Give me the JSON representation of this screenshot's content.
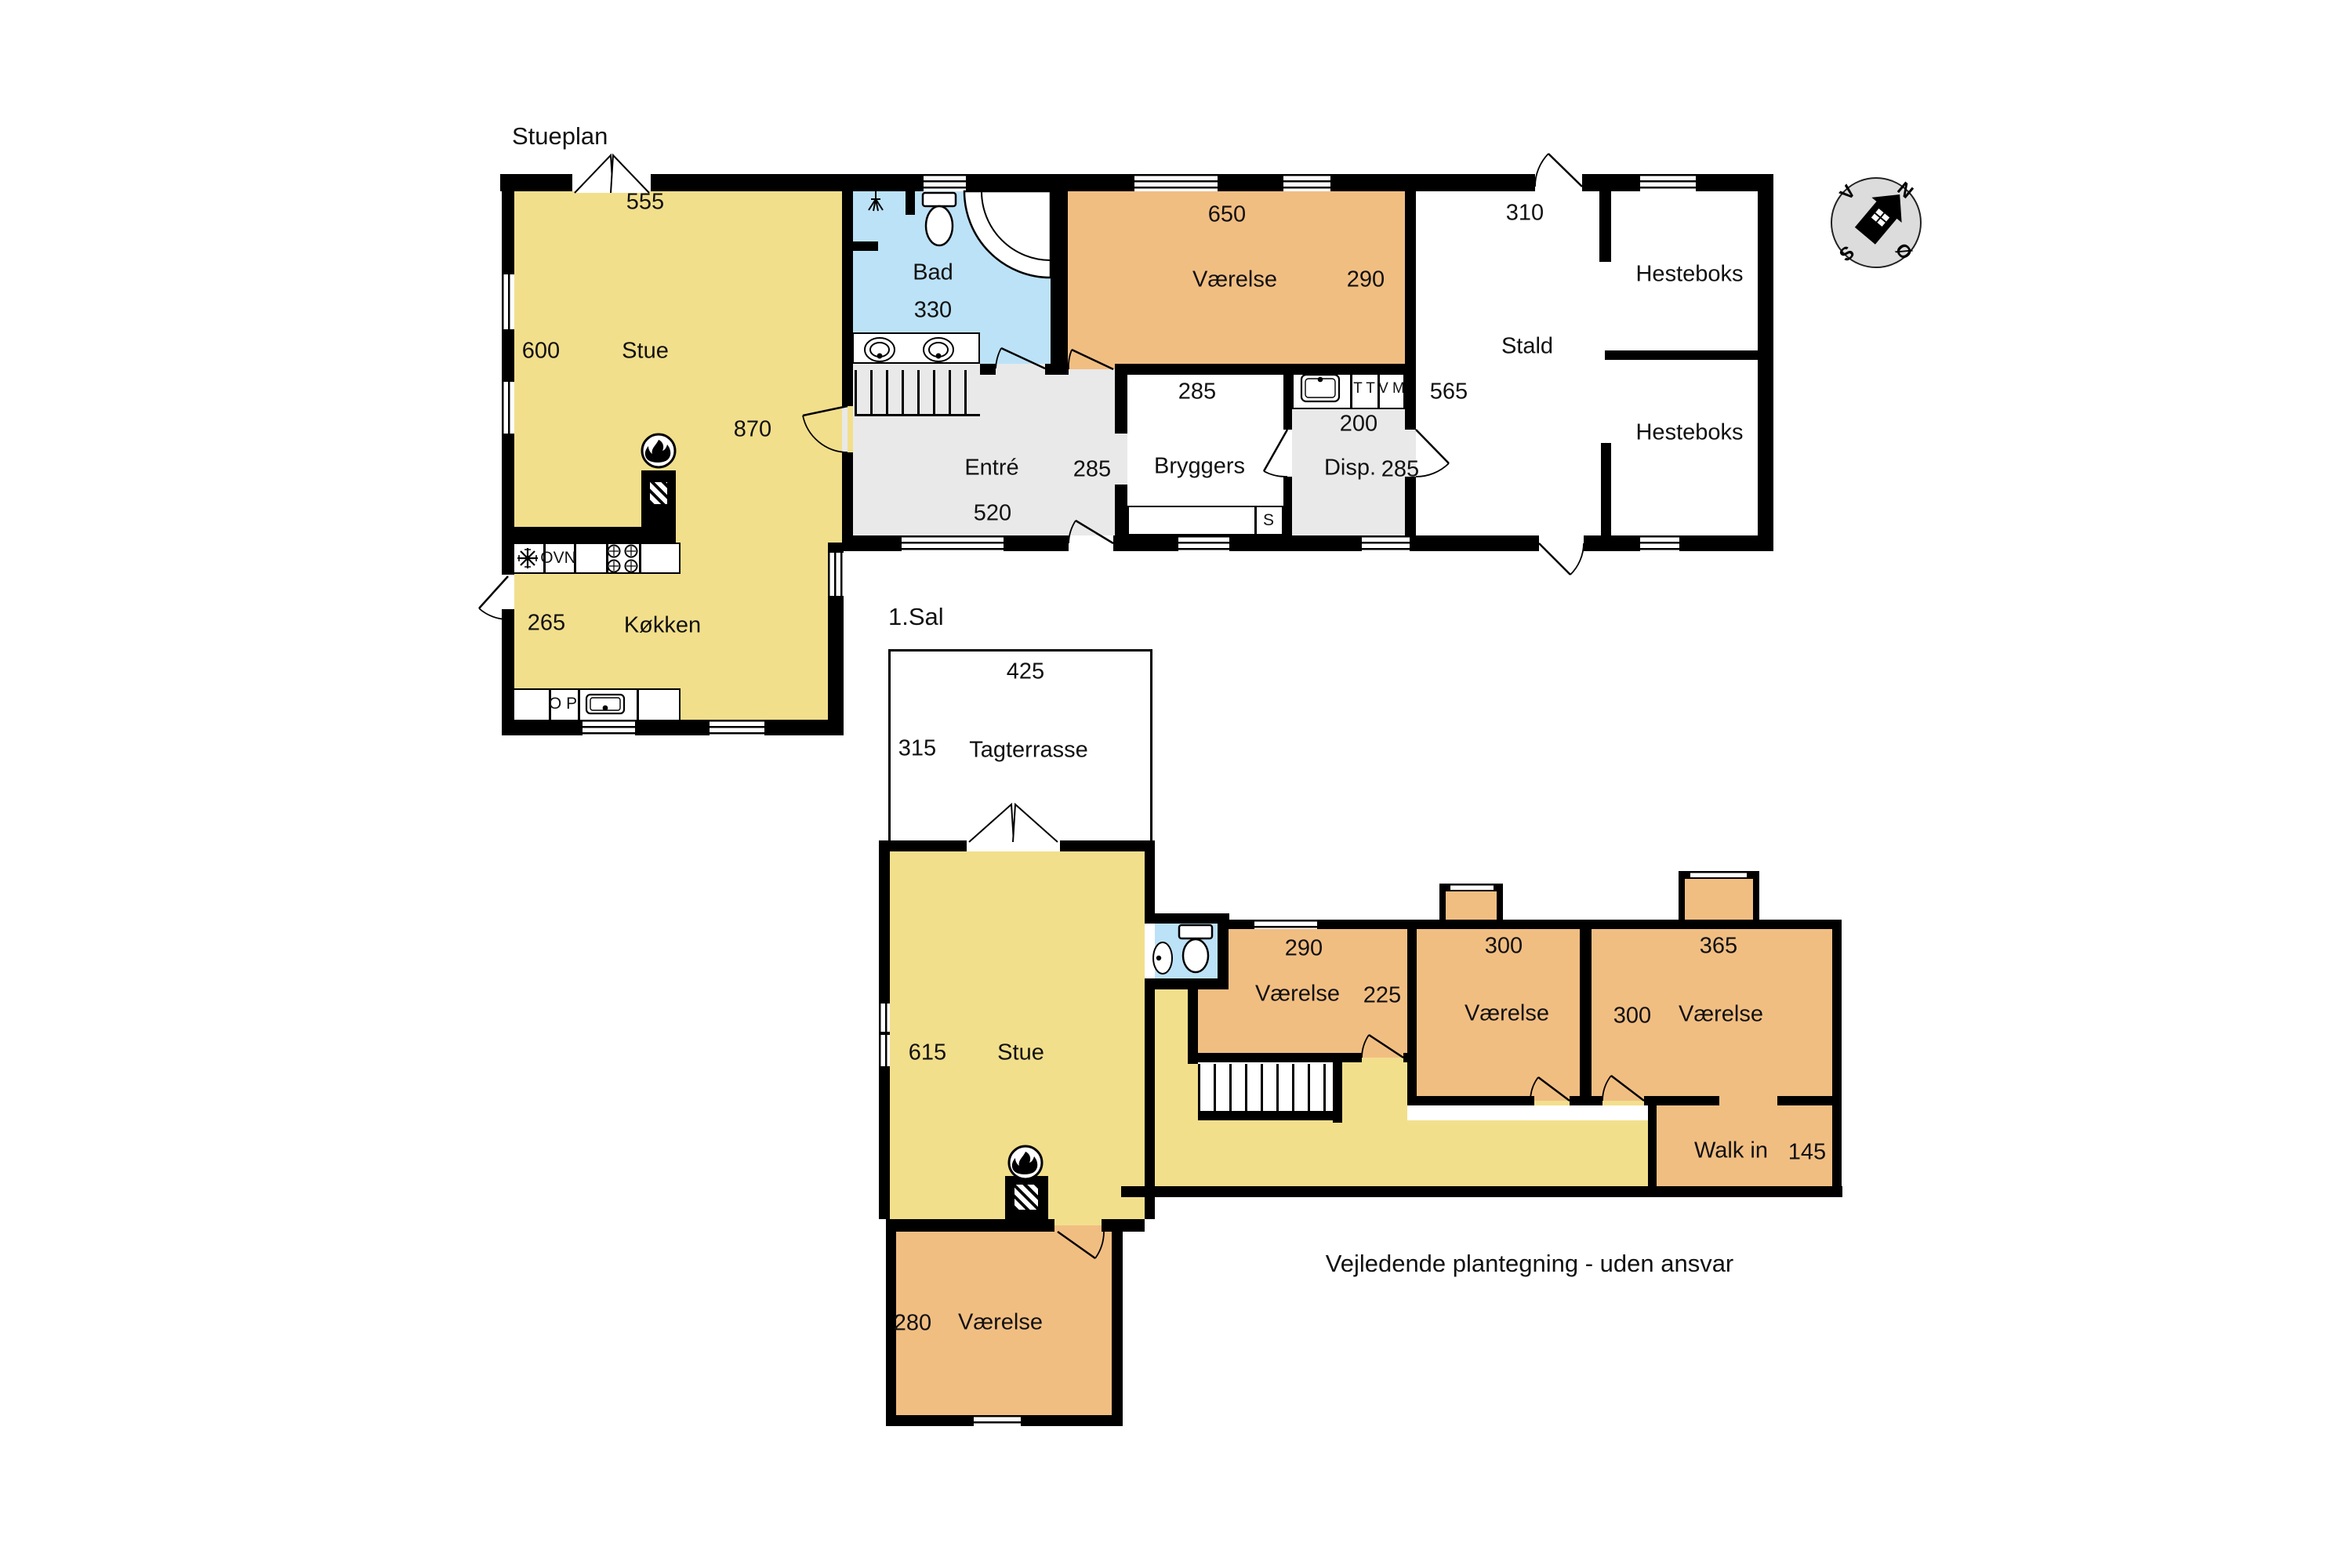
{
  "ground_floor": {
    "title": "Stueplan",
    "rooms": {
      "stue": {
        "name": "Stue",
        "dim_top": "555",
        "dim_left": "600",
        "dim_right": "870"
      },
      "koekken": {
        "name": "Køkken",
        "dim_left": "265",
        "oven": "OVN",
        "dishwasher": "O P"
      },
      "bad": {
        "name": "Bad",
        "dim": "330"
      },
      "entre": {
        "name": "Entré",
        "dim_right": "285",
        "dim_bottom": "520"
      },
      "bryggers": {
        "name": "Bryggers",
        "dim_top": "285",
        "sink": "S"
      },
      "disp": {
        "name": "Disp.",
        "dim_top": "200",
        "dim_right": "285",
        "dryer": "T T",
        "washer": "V M"
      },
      "stald": {
        "name": "Stald",
        "dim_top": "310",
        "dim_left": "565"
      },
      "hesteboks_top": {
        "name": "Hesteboks"
      },
      "hesteboks_bottom": {
        "name": "Hesteboks"
      }
    }
  },
  "first_floor": {
    "title": "1.Sal",
    "rooms": {
      "tagterrasse": {
        "name": "Tagterrasse",
        "dim_top": "425",
        "dim_left": "315"
      },
      "stue": {
        "name": "Stue",
        "dim_left": "615"
      },
      "vaerelse_1": {
        "name": "Værelse",
        "dim_top": "290",
        "dim_right": "225"
      },
      "vaerelse_2": {
        "name": "Værelse",
        "dim_top": "300"
      },
      "vaerelse_3": {
        "name": "Værelse",
        "dim_top": "365",
        "dim_left": "300"
      },
      "walk_in": {
        "name": "Walk in",
        "dim": "145"
      },
      "vaerelse_4": {
        "name": "Værelse",
        "dim_left": "280"
      }
    }
  },
  "compass": {
    "n": "N",
    "v": "V",
    "s": "S",
    "east": "Ø"
  },
  "footer": {
    "disclaimer": "Vejledende plantegning - uden ansvar"
  },
  "icons": {
    "fireplace": "fire-icon",
    "compass": "compass-rose-house-arrow",
    "shower": "shower-head-icon",
    "freezer": "snowflake-icon",
    "hob": "four-burner-hob-icon"
  },
  "colors": {
    "living_yellow": "#F2DF8C",
    "bedroom_orange": "#F1BE82",
    "bath_blue": "#BCE2F7",
    "hall_gray": "#E9E9E9",
    "wall_black": "#000000",
    "compass_bg": "#DCDCDC"
  }
}
